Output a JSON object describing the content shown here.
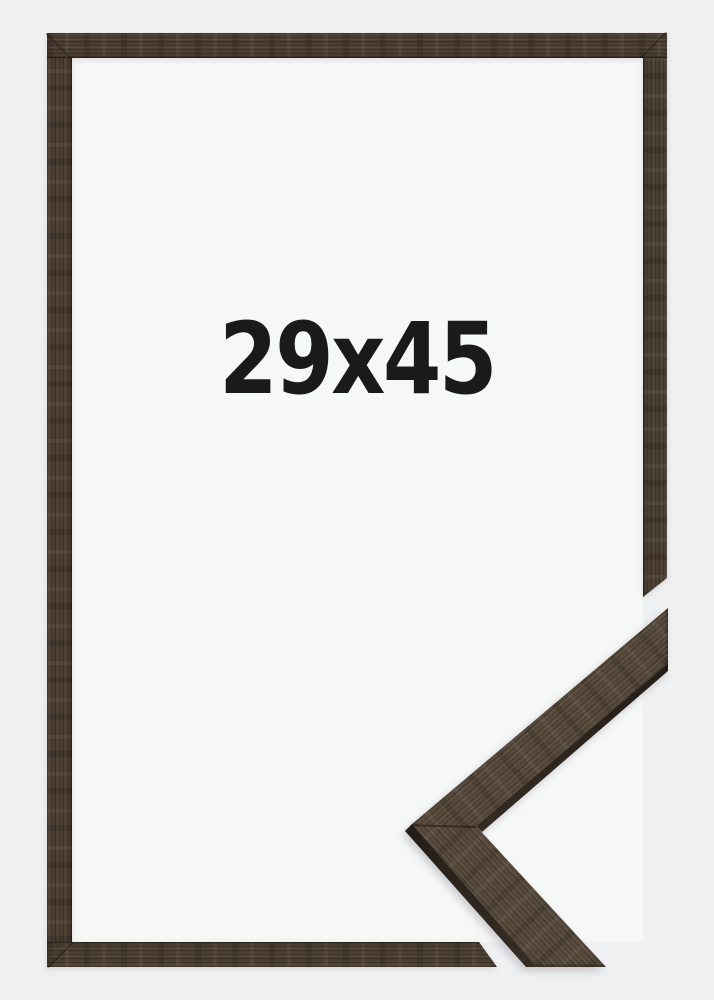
{
  "frame_product_image": {
    "size_label": "29x45",
    "colors": {
      "background": "#eff0f1",
      "opening": "#f6f7f7",
      "wood": "#4a3e32",
      "wood_face": "#564a3c",
      "wood_dark": "#2a231d",
      "text": "#1a1a1a"
    }
  }
}
